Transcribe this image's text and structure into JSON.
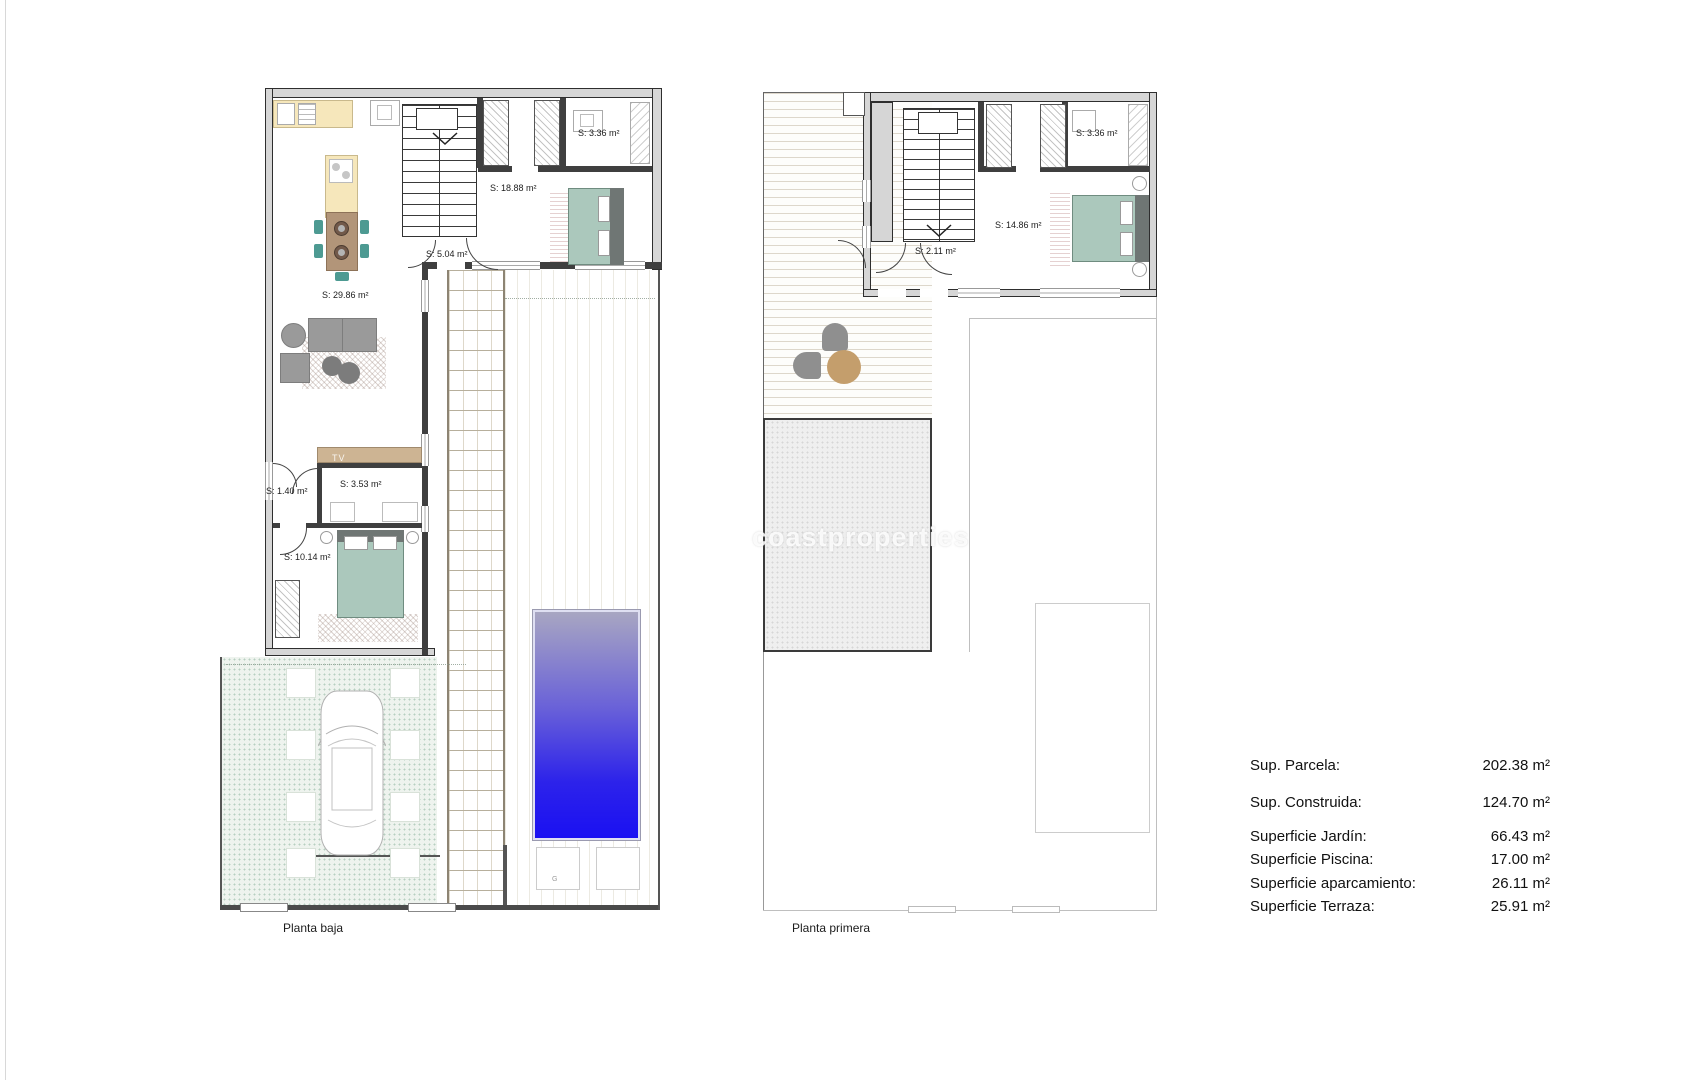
{
  "page": {
    "watermark": "coastproperties"
  },
  "ground_floor": {
    "title": "Planta baja",
    "room_labels": {
      "living_kitchen": "S: 29.86 m²",
      "bedroom_main": "S: 18.88 m²",
      "hall": "S: 5.04 m²",
      "bath_top": "S: 3.36 m²",
      "wc": "S: 1.40 m²",
      "bath_mid": "S: 3.53 m²",
      "bedroom_small": "S: 10.14 m²"
    },
    "tv_label": "TV",
    "garage_mark": "G"
  },
  "first_floor": {
    "title": "Planta primera",
    "room_labels": {
      "hall": "S: 2.11 m²",
      "bedroom": "S: 14.86 m²",
      "bath": "S: 3.36 m²"
    }
  },
  "legend": {
    "rows": [
      {
        "label": "Sup. Parcela:",
        "value": "202.38 m²"
      },
      {
        "label": "Sup. Construida:",
        "value": "124.70 m²"
      },
      {
        "label": "Superficie Jardín:",
        "value": "66.43 m²"
      },
      {
        "label": "Superficie Piscina:",
        "value": "17.00 m²"
      },
      {
        "label": "Superficie aparcamiento:",
        "value": "26.11 m²"
      },
      {
        "label": "Superficie Terraza:",
        "value": "25.91 m²"
      }
    ]
  },
  "colors": {
    "pool_top": "#a8a6c2",
    "pool_bottom": "#1a10f2",
    "bed_teal": "#abc8bc",
    "kitchen_cream": "#f6e7bb",
    "table_tan": "#b29579",
    "chair_teal": "#4d9a92"
  }
}
